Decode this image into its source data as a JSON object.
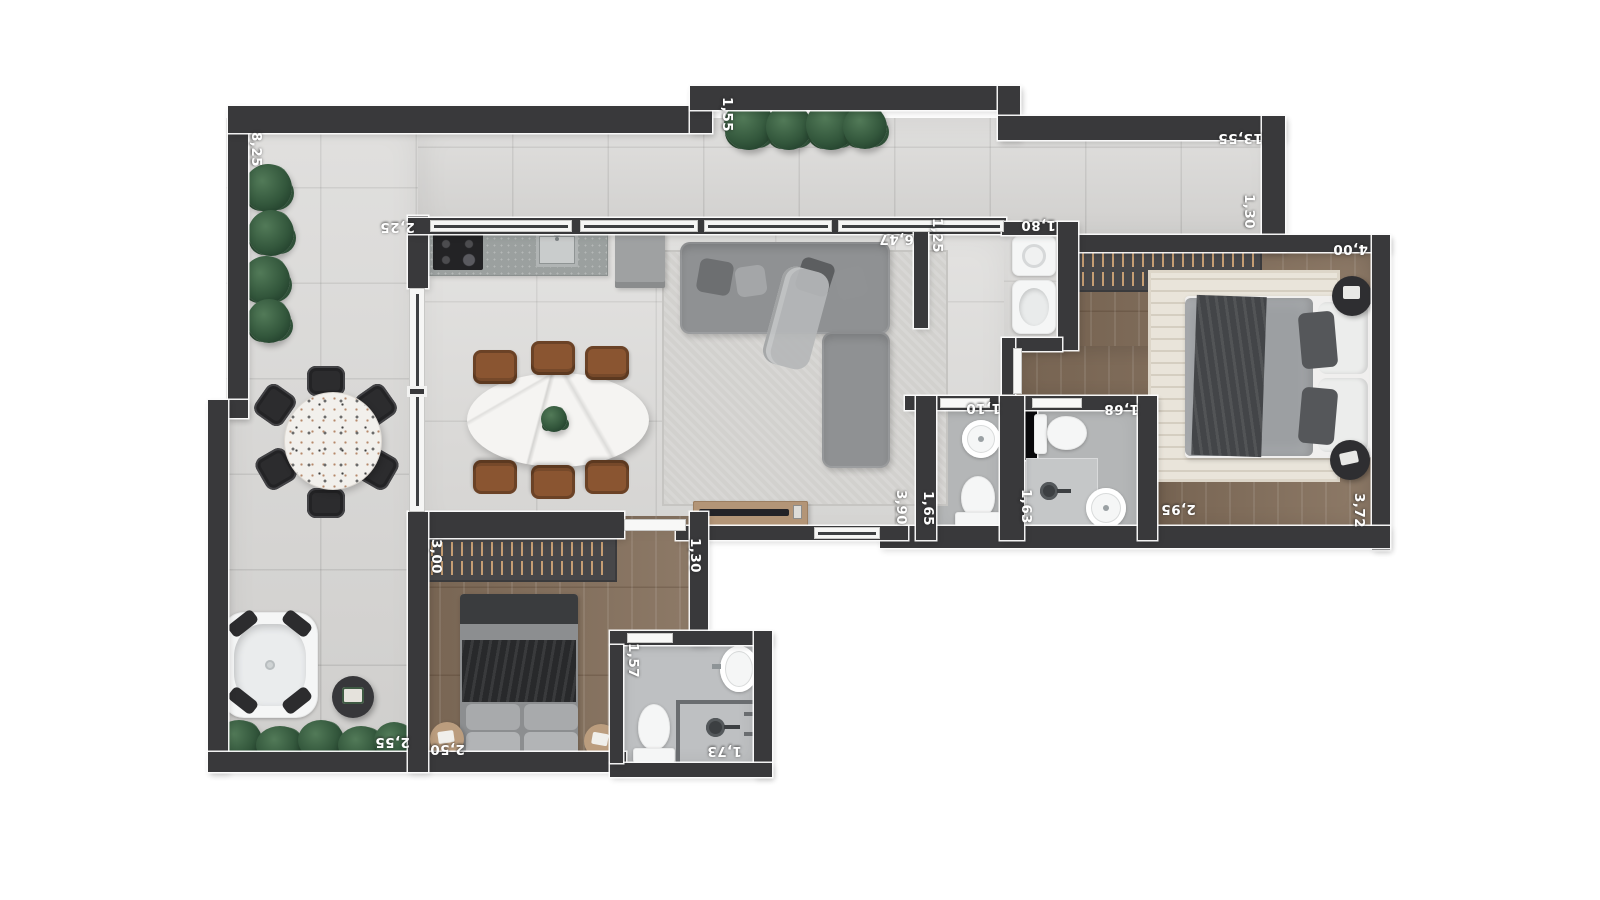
{
  "floorplan": {
    "type": "apartment-floor-plan-top-view",
    "colors": {
      "wall": "#39393b",
      "terrace_tile": "#d8d7d5",
      "indoor_tile": "#dcdbd9",
      "wood_floor": "#85705c",
      "bathroom_floor": "#b4b6b7",
      "plant_green": "#33573c",
      "leather_chair": "#8a5531",
      "label_text": "#ffffff"
    },
    "dims": [
      {
        "value": "8,25",
        "location": "terrace-left-wall"
      },
      {
        "value": "2,25",
        "location": "kitchen-wall"
      },
      {
        "value": "1,55",
        "location": "balcony-top"
      },
      {
        "value": "13,55",
        "location": "balcony-top-right"
      },
      {
        "value": "1,30",
        "location": "balcony-right"
      },
      {
        "value": "6,47",
        "location": "living-room-top-right"
      },
      {
        "value": "1,25",
        "location": "living-room-right-wall"
      },
      {
        "value": "1,80",
        "location": "laundry"
      },
      {
        "value": "4,00",
        "location": "bedroom-1-top"
      },
      {
        "value": "1,10",
        "location": "bathroom-1-top"
      },
      {
        "value": "1,68",
        "location": "bathroom-2-top"
      },
      {
        "value": "3,90",
        "location": "hall-bottom"
      },
      {
        "value": "1,65",
        "location": "bathroom-1-left-wall"
      },
      {
        "value": "1,63",
        "location": "bathroom-2-left-wall"
      },
      {
        "value": "2,95",
        "location": "bedroom-1-bottom"
      },
      {
        "value": "3,72",
        "location": "bedroom-1-right"
      },
      {
        "value": "3,00",
        "location": "bedroom-2-wardrobe"
      },
      {
        "value": "1,30",
        "location": "bedroom-2-right-wall"
      },
      {
        "value": "2,50",
        "location": "bedroom-2-bottom"
      },
      {
        "value": "2,55",
        "location": "terrace-bottom"
      },
      {
        "value": "1,57",
        "location": "bathroom-3-left"
      },
      {
        "value": "1,73",
        "location": "bathroom-3-bottom"
      }
    ]
  }
}
